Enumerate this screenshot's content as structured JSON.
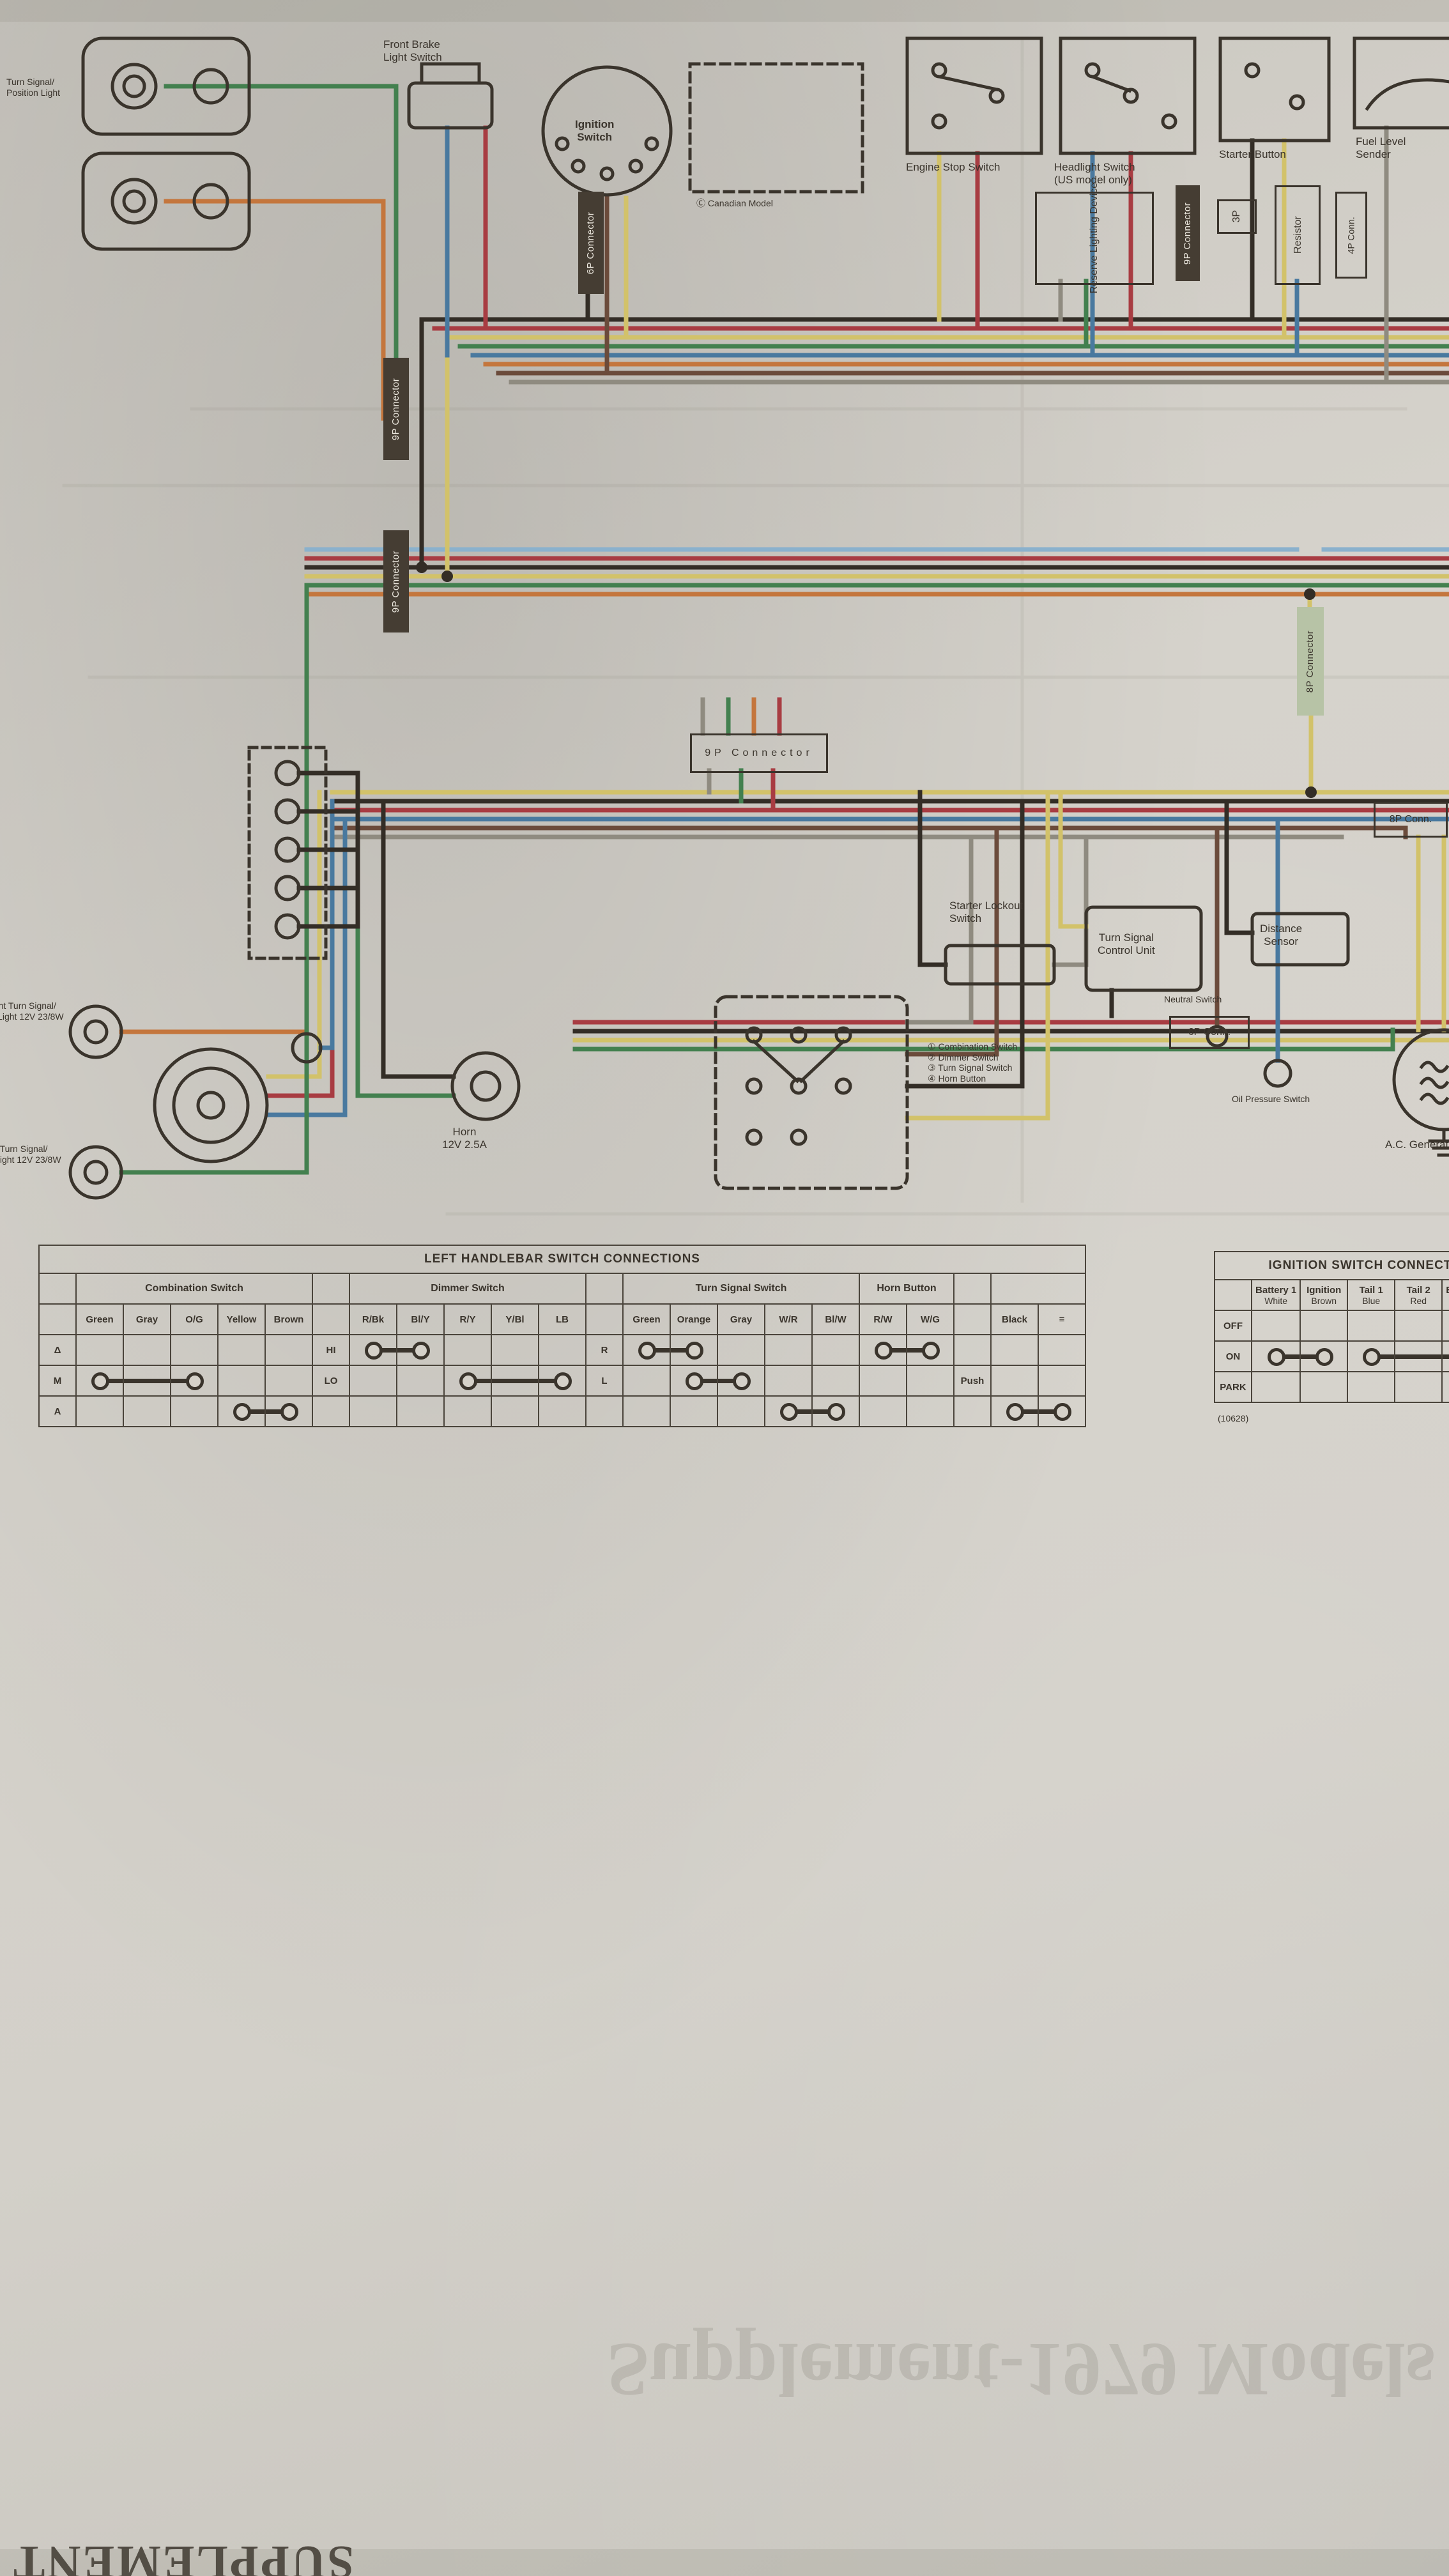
{
  "palette": {
    "paper": "#d5d1c9",
    "ink": "#3a342c",
    "black": "#332d26",
    "red": "#a83c42",
    "yellow": "#d2c26a",
    "green": "#43804f",
    "blue": "#49799f",
    "lightblue": "#8ab1cd",
    "orange": "#c4763d",
    "brown": "#6b4b3b",
    "gray": "#8f8b80",
    "white": "#e9e5da",
    "pink": "#c79aa4"
  },
  "labels": {
    "ts_position": "Turn Signal/\nPosition Light",
    "front_brake": "Front Brake\nLight Switch",
    "ignition_switch": "Ignition\nSwitch",
    "canadian": "Ⓒ Canadian Model",
    "engine_stop": "Engine Stop Switch",
    "headlight_sw": "Headlight Switch\n(US model only)",
    "starter_button": "Starter Button",
    "fuel_sender": "Fuel Level\nSender",
    "reserve": "Reserve Lighting Device",
    "conn9p_a": "9P Connector",
    "conn9p_b": "9P Connector",
    "conn9p_mid": "9P Connector",
    "conn9p_r": "9P Connector",
    "conn6p_bar": "6P Connector",
    "conn8p_bar": "8P Connector",
    "conn3p": "3P",
    "resistor": "Resistor",
    "conn4p_a": "4P Conn.",
    "conn4p_b": "4P Conn.",
    "conn8p_s": "8P Conn.",
    "conn6p_s1": "6P Conn.",
    "conn6p_s2": "6P Conn.",
    "conn6p_s3": "6P Conn.",
    "ignition_coils": "Ignition Coils",
    "spark_plugs": "Spark Plugs",
    "contact_breaker": "Contact Breaker\nPoints",
    "hazard_relay": "Hazard\nRelay",
    "rear_brake_sw": "Rear Brake\nLight Switch",
    "ts_relay": "Turn Signal Light Relay\n12V 23W x 2 + 3.4W",
    "rectifier": "Rectifier",
    "tail_light": "Tail/Brake Light\n12V 8/23W",
    "rear_right": "Rear Right Turn Signal\nLight 12V 23W",
    "rear_left": "Rear Left Turn Signal\nLight 12V 23W",
    "battery": "Battery\n12V 14AH",
    "fuse20": "Fuse 20A",
    "fuse10a": "Fuse 10A",
    "fuse10b": "Fuse 10A",
    "fuse2a": "Fuse 2A",
    "fuse2b": "Fuse 2A",
    "starter_motor": "Starter Motor",
    "starter_relay": "Starter\nRelay",
    "regulator": "Regulator",
    "ac_gen": "A.C. Generator",
    "oil_sw": "Oil Pressure Switch",
    "neutral_sw": "Neutral Switch",
    "distance": "Distance\nSensor",
    "tscu": "Turn Signal\nControl Unit",
    "lockout": "Starter Lockout\nSwitch",
    "horn": "Horn\n12V 2.5A",
    "legend": "① Combination Switch\n② Dimmer Switch\n③ Turn Signal Switch\n④ Horn Button",
    "frag_right": "Front Right Turn Signal/\nRunning Light 12V 23/8W",
    "frag_left": "Front Left Turn Signal/\nRunning Light 12V 23/8W",
    "note": "✱ This is a lead used for an ammeter shunt.\n   See the Electrical Section for details.",
    "star": "✱",
    "plus": "+",
    "minus": "−",
    "footnote": "(10628)",
    "supplement": "SUPPLEMENT",
    "watermark": "Supplement-1979 Models"
  },
  "tables": {
    "left": {
      "title": "LEFT HANDLEBAR SWITCH CONNECTIONS",
      "groups": [
        {
          "name": "Combination Switch",
          "rows": [
            "Δ",
            "M",
            "A"
          ],
          "cols": [
            "Green",
            "Gray",
            "O/G",
            "Yellow",
            "Brown"
          ],
          "cells": [
            [
              "",
              "",
              "",
              "",
              ""
            ],
            [
              "a",
              "m",
              "b",
              "",
              ""
            ],
            [
              "",
              "",
              "",
              "a",
              "b"
            ]
          ]
        },
        {
          "name": "Dimmer Switch",
          "rows": [
            "HI",
            "LO",
            ""
          ],
          "cols": [
            "R/Bk",
            "Bl/Y",
            "R/Y",
            "Y/Bl",
            "LB"
          ],
          "cells": [
            [
              "a",
              "b",
              "",
              "",
              ""
            ],
            [
              "",
              "",
              "a",
              "m",
              "b"
            ],
            [
              "",
              "",
              "",
              "",
              ""
            ]
          ]
        },
        {
          "name": "Turn Signal Switch",
          "rows": [
            "R",
            "L",
            ""
          ],
          "cols": [
            "Green",
            "Orange",
            "Gray",
            "W/R",
            "Bl/W"
          ],
          "cells": [
            [
              "a",
              "b",
              "",
              "",
              ""
            ],
            [
              "",
              "a",
              "b",
              "",
              ""
            ],
            [
              "",
              "",
              "",
              "a",
              "b"
            ]
          ]
        },
        {
          "name": "Horn Button",
          "rows": null,
          "cols": [
            "R/W",
            "W/G"
          ],
          "cells": [
            [
              "a",
              "b"
            ],
            [
              "",
              ""
            ],
            [
              "",
              ""
            ]
          ]
        },
        {
          "name": "",
          "rows": [
            "",
            "Push",
            ""
          ],
          "cols": [
            "Black",
            "≡"
          ],
          "cells": [
            [
              "",
              ""
            ],
            [
              "",
              ""
            ],
            [
              "a",
              "b"
            ]
          ]
        }
      ]
    },
    "ignition": {
      "title": "IGNITION SWITCH CONNECTIONS",
      "groups": [
        {
          "name": "",
          "rows": [
            "OFF",
            "ON",
            "PARK"
          ],
          "cols": [
            [
              "Battery 1",
              "White"
            ],
            [
              "Ignition",
              "Brown"
            ],
            [
              "Tail 1",
              "Blue"
            ],
            [
              "Tail 2",
              "Red"
            ],
            [
              "Battery 2",
              "White"
            ],
            [
              "Tail 3",
              "G/O"
            ]
          ],
          "cells": [
            [
              "",
              "",
              "",
              "",
              "",
              ""
            ],
            [
              "a",
              "b",
              "a",
              "m",
              "b",
              ""
            ],
            [
              "",
              "",
              "",
              "",
              "a",
              "b"
            ]
          ]
        }
      ]
    },
    "right": {
      "title": "RIGHT HANDLEBAR SWITCH CONNECTIONS",
      "groups": [
        {
          "name": "Engine Stop Switch",
          "rows": [
            "OFF",
            "RUN",
            "OFF"
          ],
          "cols": [
            "Brown",
            "Y/R"
          ],
          "cells": [
            [
              "",
              ""
            ],
            [
              "a",
              "b"
            ],
            [
              "",
              ""
            ]
          ]
        },
        {
          "name": "Headlight Switch",
          "rows": null,
          "cols": [
            "Brown",
            "Bl/W",
            "Br/W"
          ],
          "cells": [
            [
              "",
              "",
              ""
            ],
            [
              "a",
              "m",
              "b"
            ],
            [
              "",
              "",
              ""
            ]
          ]
        },
        {
          "name": "Starter Button",
          "rows": [
            "",
            "Push",
            ""
          ],
          "cols": [
            "Black",
            "Y/R"
          ],
          "cells": [
            [
              "",
              ""
            ],
            [
              "",
              ""
            ],
            [
              "a",
              "b"
            ]
          ]
        }
      ]
    }
  }
}
